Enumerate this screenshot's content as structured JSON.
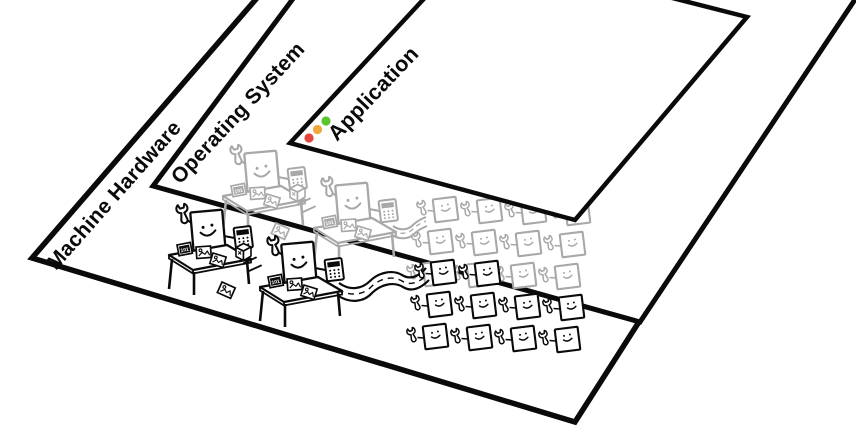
{
  "canvas": {
    "background": "#ffffff",
    "ink": "#0a0a0a",
    "faded_ink": "#a8a8a8"
  },
  "layers": {
    "machine_hardware": {
      "label": "Machine Hardware"
    },
    "operating_system": {
      "label": "Operating System"
    },
    "application": {
      "label": "Application"
    }
  },
  "application_window": {
    "controls": [
      {
        "name": "close",
        "color": "#e2463c"
      },
      {
        "name": "minimize",
        "color": "#f0a73c"
      },
      {
        "name": "zoom",
        "color": "#5bc42e"
      }
    ]
  },
  "chip_label": "101",
  "crews": {
    "faded_rows": 3,
    "front_rows": 3,
    "columns": 4
  },
  "icons": {
    "wrench": "open-end-wrench",
    "calculator": "keypad-calculator",
    "data_chip": "chip-101",
    "image_chip": "chip-picture",
    "cube": "3d-box",
    "worker": "smiling-square-with-wrench",
    "engineer": "smiling-figure-at-desk",
    "road": "wavy-road-dashed-centerline",
    "window_controls": "traffic-light-dots"
  }
}
